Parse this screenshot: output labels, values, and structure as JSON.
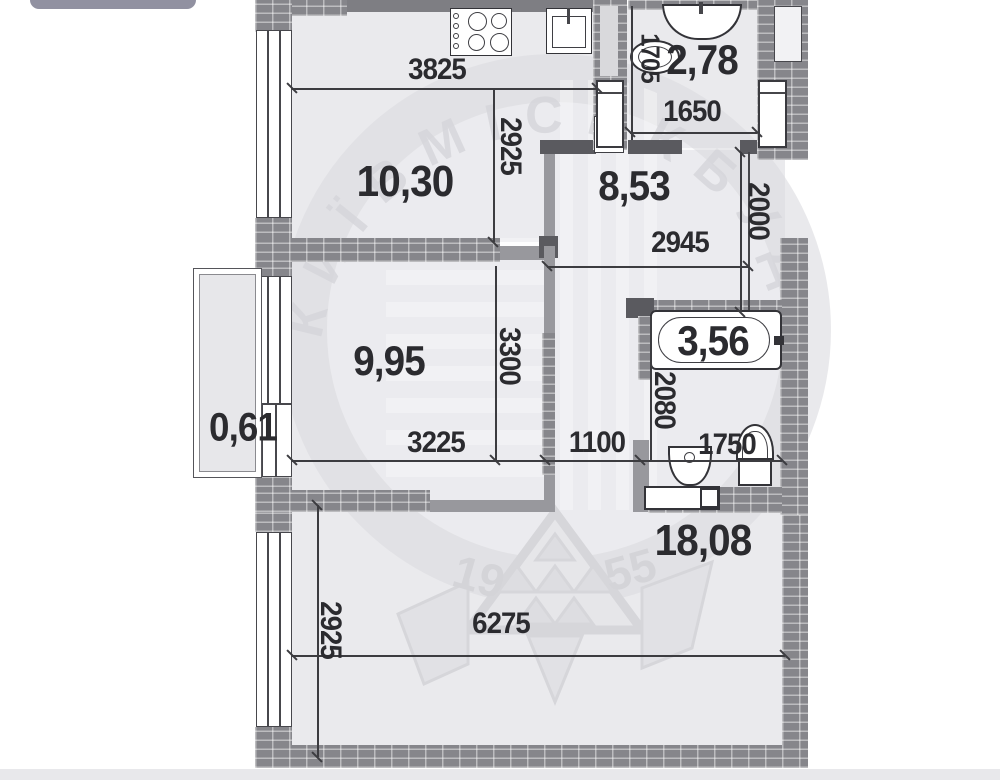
{
  "watermark": {
    "brand": "КИЇВМІСЬКБУД",
    "year_left": "19",
    "year_right": "55"
  },
  "rooms": {
    "kitchen": "10,30",
    "wc": "2,78",
    "hall": "8,53",
    "bedroom": "9,95",
    "balcony": "0,61",
    "bath": "3,56",
    "living": "18,08"
  },
  "dims": {
    "kitchen_width": "3825",
    "kitchen_depth": "2925",
    "wc_width": "1650",
    "wc_depth": "1705",
    "hall_width": "2945",
    "hall_depth": "2000",
    "bedroom_width": "3225",
    "bedroom_depth": "3300",
    "hall_passage": "1100",
    "bath_width": "1750",
    "bath_depth": "2080",
    "living_width": "6275",
    "living_depth": "2925"
  }
}
